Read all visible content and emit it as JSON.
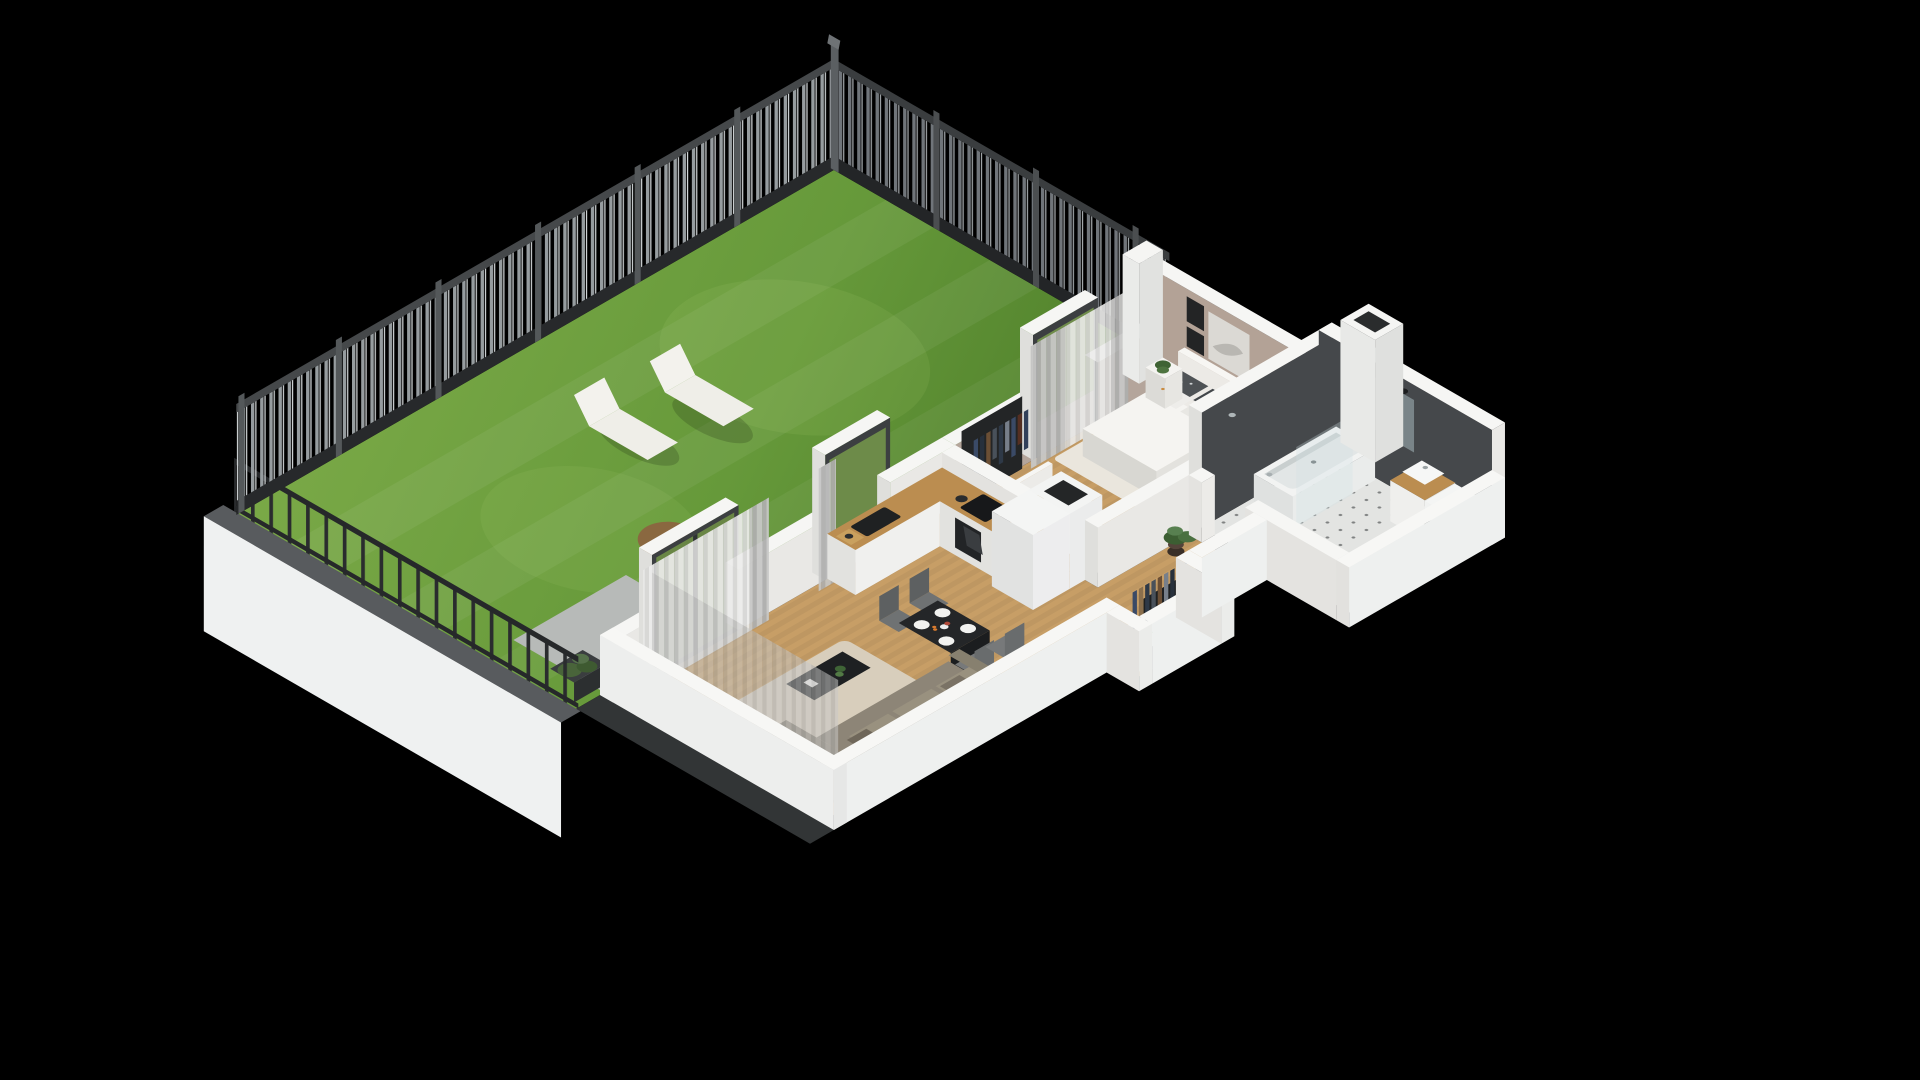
{
  "palette": {
    "bg": "#000000",
    "lawn1": "#7aa947",
    "lawn2": "#4e7e2a",
    "patio": "#b7bab8",
    "fenceLight": "#969c9f",
    "wallTop": "#f6f6f4",
    "wallSE": "#e9e8e5",
    "wallSW": "#dfdfdc",
    "wallExt": "#eef0ef",
    "wood": "#c79e66",
    "counterWood": "#bb8d50",
    "tile": "#45484b",
    "bedWall": "#b4a59b",
    "sofa": "#8d8577",
    "rugL": "#d9d0bf",
    "rugB": "#eceae4",
    "duvet": "#f5f4f1",
    "bathFloor": "#e3e4e2",
    "egg": "#8a6840",
    "black": "#1e2022",
    "chair": "#6f7273"
  },
  "scene": {
    "type": "isometric-cutaway-floorplan-render",
    "background": "black",
    "garden": [
      "lawn",
      "metal-picket-fence",
      "low-railing-on-white-wall",
      "sun-lounger",
      "sun-lounger",
      "hanging-egg-chair",
      "paver-patio",
      "planter-shrubs"
    ],
    "living_room": [
      "corner-sofa",
      "coffee-table",
      "area-rug",
      "sheer-curtains",
      "tall-window"
    ],
    "dining": [
      "black-dining-table",
      "four-gray-chairs",
      "plates",
      "vase",
      "fruit"
    ],
    "kitchen": [
      "l-shaped-counter",
      "black-sink",
      "faucet",
      "induction-cooktop",
      "oven",
      "coffee-machine",
      "kettle",
      "cutting-board",
      "fridge-with-snowflake-symbol",
      "dark-shaft"
    ],
    "hallway": [
      "open-wardrobe-with-clothes",
      "potted-plant",
      "open-white-doors",
      "wood-plank-floor"
    ],
    "bedroom": [
      "double-bed",
      "white-duvet",
      "patterned-pillows",
      "headboard",
      "nightstand-left",
      "nightstand-right",
      "table-lamp",
      "plant",
      "three-wall-pictures",
      "open-wardrobe-with-clothes",
      "window-with-curtains",
      "white-rug"
    ],
    "bathroom": [
      "bathtub",
      "shower-glass-screen",
      "mirror",
      "two-black-sconces",
      "vanity-with-vessel-sink",
      "washing-machine",
      "dark-gray-tiled-walls",
      "patterned-tile-floor",
      "service-shaft-block"
    ]
  }
}
